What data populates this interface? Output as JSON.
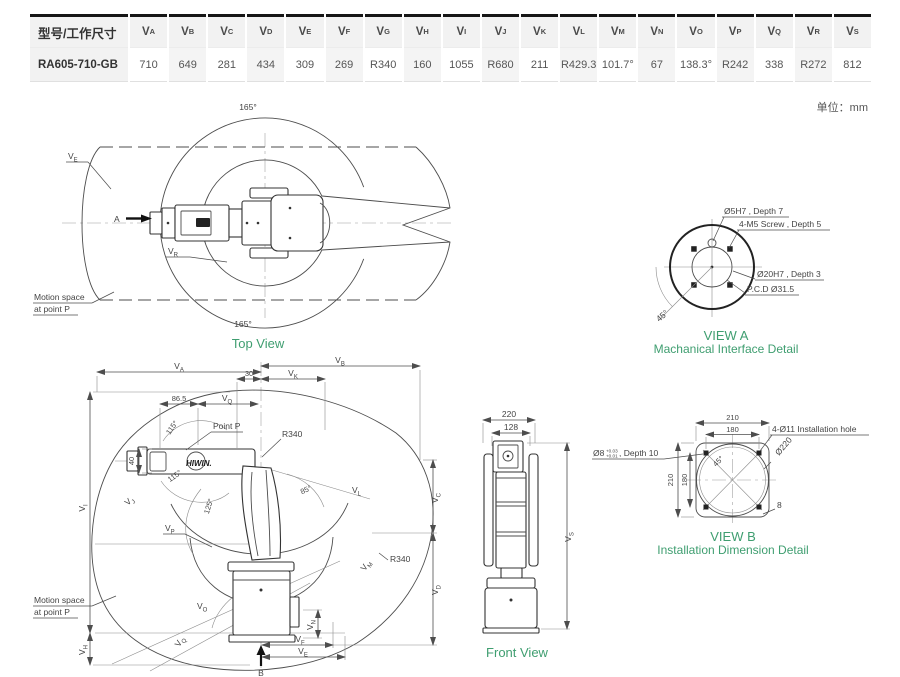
{
  "colors": {
    "accent_green": "#3f9e70",
    "line": "#4d4d4d",
    "table_shade": "#f2f2f2"
  },
  "unit_note": "单位：mm",
  "table": {
    "first_header": "型号/工作尺寸",
    "headers": [
      {
        "v": "V",
        "s": "A"
      },
      {
        "v": "V",
        "s": "B"
      },
      {
        "v": "V",
        "s": "C"
      },
      {
        "v": "V",
        "s": "D"
      },
      {
        "v": "V",
        "s": "E"
      },
      {
        "v": "V",
        "s": "F"
      },
      {
        "v": "V",
        "s": "G"
      },
      {
        "v": "V",
        "s": "H"
      },
      {
        "v": "V",
        "s": "I"
      },
      {
        "v": "V",
        "s": "J"
      },
      {
        "v": "V",
        "s": "K"
      },
      {
        "v": "V",
        "s": "L"
      },
      {
        "v": "V",
        "s": "M"
      },
      {
        "v": "V",
        "s": "N"
      },
      {
        "v": "V",
        "s": "O"
      },
      {
        "v": "V",
        "s": "P"
      },
      {
        "v": "V",
        "s": "Q"
      },
      {
        "v": "V",
        "s": "R"
      },
      {
        "v": "V",
        "s": "S"
      }
    ],
    "model": "RA605-710-GB",
    "values": [
      "710",
      "649",
      "281",
      "434",
      "309",
      "269",
      "R340",
      "160",
      "1055",
      "R680",
      "211",
      "R429.3",
      "101.7°",
      "67",
      "138.3°",
      "R242",
      "338",
      "R272",
      "812"
    ]
  },
  "top_view": {
    "caption": "Top View",
    "angle_top": "165°",
    "angle_bottom": "165°",
    "ve": {
      "v": "V",
      "s": "E"
    },
    "vr": {
      "v": "V",
      "s": "R"
    },
    "arrow_label": "A",
    "note_line1": "Motion space",
    "note_line2": "at point P"
  },
  "side_view": {
    "va": {
      "v": "V",
      "s": "A"
    },
    "vb": {
      "v": "V",
      "s": "B"
    },
    "vk": {
      "v": "V",
      "s": "K"
    },
    "d30": "30",
    "d86_5": "86.5",
    "vq_top": {
      "v": "V",
      "s": "Q"
    },
    "a115_top": "115°",
    "a115_bottom": "115°",
    "point_p": "Point P",
    "r340_top": "R340",
    "d40": "40",
    "vi": {
      "v": "V",
      "s": "I"
    },
    "vj": {
      "v": "V",
      "s": "J"
    },
    "a85": "85°",
    "vl": {
      "v": "V",
      "s": "L"
    },
    "a125": "125°",
    "vc": {
      "v": "V",
      "s": "C"
    },
    "vd": {
      "v": "V",
      "s": "D"
    },
    "vp": {
      "v": "V",
      "s": "P"
    },
    "vm": {
      "v": "V",
      "s": "M"
    },
    "r340_bottom": "R340",
    "vo": {
      "v": "V",
      "s": "O"
    },
    "vq_bottom": {
      "v": "V",
      "s": "Q"
    },
    "vn": {
      "v": "V",
      "s": "N"
    },
    "vh": {
      "v": "V",
      "s": "H"
    },
    "vf": {
      "v": "V",
      "s": "F"
    },
    "ve": {
      "v": "V",
      "s": "E"
    },
    "arrow_label": "B",
    "note_line1": "Motion space",
    "note_line2": "at point P",
    "logo": "HIWIN."
  },
  "front_view": {
    "caption": "Front View",
    "d220": "220",
    "d128": "128",
    "vs": {
      "v": "V",
      "s": "S"
    }
  },
  "view_a": {
    "caption_line1": "VIEW A",
    "caption_line2": "Machanical Interface Detail",
    "pin_hole": "Ø5H7 , Depth 7",
    "screw": "4-M5 Screw , Depth 5",
    "bore": "Ø20H7 , Depth 3",
    "pcd": "P.C.D Ø31.5",
    "a45": "45°"
  },
  "view_b": {
    "caption_line1": "VIEW B",
    "caption_line2": "Installation Dimension Detail",
    "d210_top": "210",
    "d180_top": "180",
    "holes": "4-Ø11 Installation hole",
    "d220": "Ø220",
    "pin": "Ø8",
    "pin_tol_top": "+0.03",
    "pin_tol_bottom": "+0.01",
    "pin_suffix": ", Depth 10",
    "d210_left": "210",
    "d180_left": "180",
    "a45": "45°",
    "d8": "8"
  }
}
